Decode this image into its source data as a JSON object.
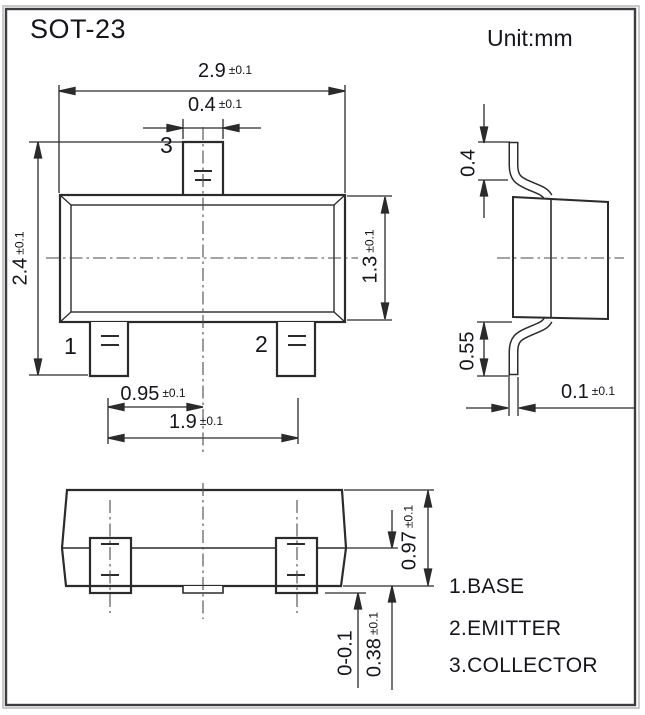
{
  "frame": {
    "title": "SOT-23",
    "unit_label": "Unit:mm"
  },
  "front_view": {
    "pin_top": "3",
    "pin_left": "1",
    "pin_right": "2",
    "dim_body_width": {
      "value": "2.9",
      "tol": "±0.1"
    },
    "dim_pin_width": {
      "value": "0.4",
      "tol": "±0.1"
    },
    "dim_total_height": {
      "value": "2.4",
      "tol": "±0.1"
    },
    "dim_body_height": {
      "value": "1.3",
      "tol": "±0.1"
    },
    "dim_pin_pitch": {
      "value": "0.95",
      "tol": "±0.1"
    },
    "dim_pin_span": {
      "value": "1.9",
      "tol": "±0.1"
    }
  },
  "side_view": {
    "dim_lead_top_length": {
      "value": "0.4",
      "tol": ""
    },
    "dim_lead_bottom_length": {
      "value": "0.55",
      "tol": ""
    },
    "dim_lead_thickness": {
      "value": "0.1",
      "tol": "±0.1"
    }
  },
  "bottom_view": {
    "dim_body_thickness": {
      "value": "0.97",
      "tol": "±0.1"
    },
    "dim_lead_height": {
      "value": "0.38",
      "tol": "±0.1"
    },
    "dim_standoff": {
      "value": "0-0.1",
      "tol": ""
    }
  },
  "legend": [
    "1.BASE",
    "2.EMITTER",
    "3.COLLECTOR"
  ],
  "colors": {
    "line": "#2b2b2b",
    "text": "#15151b",
    "background": "#ffffff"
  }
}
